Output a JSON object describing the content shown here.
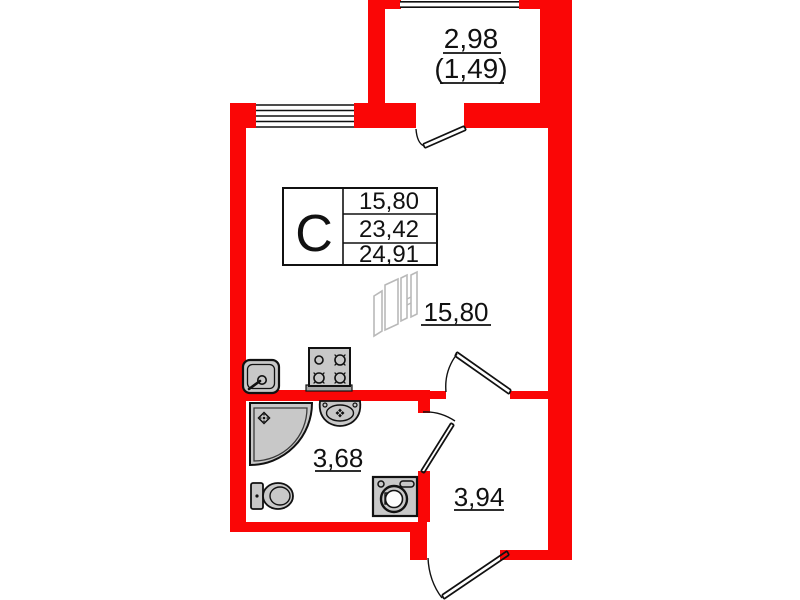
{
  "colors": {
    "wall_red": "#fa0606",
    "fixture_gray": "#c8c8c8",
    "line_black": "#111111",
    "wardrobe_gray": "#b9b9b9"
  },
  "balcony": {
    "area_total": "2,98",
    "area_counted": "(1,49)"
  },
  "summary_table": {
    "type_label": "С",
    "rows": [
      "15,80",
      "23,42",
      "24,91"
    ]
  },
  "rooms": {
    "living_area": "15,80",
    "bathroom_area": "3,68",
    "hallway_area": "3,94"
  },
  "icons": {
    "kitchen_sink": "kitchen-sink-icon",
    "stove": "stove-icon",
    "wardrobe": "wardrobe-icon",
    "shower": "shower-icon",
    "bathroom_sink": "bathroom-sink-icon",
    "toilet": "toilet-icon",
    "washing_machine": "washing-machine-icon"
  }
}
